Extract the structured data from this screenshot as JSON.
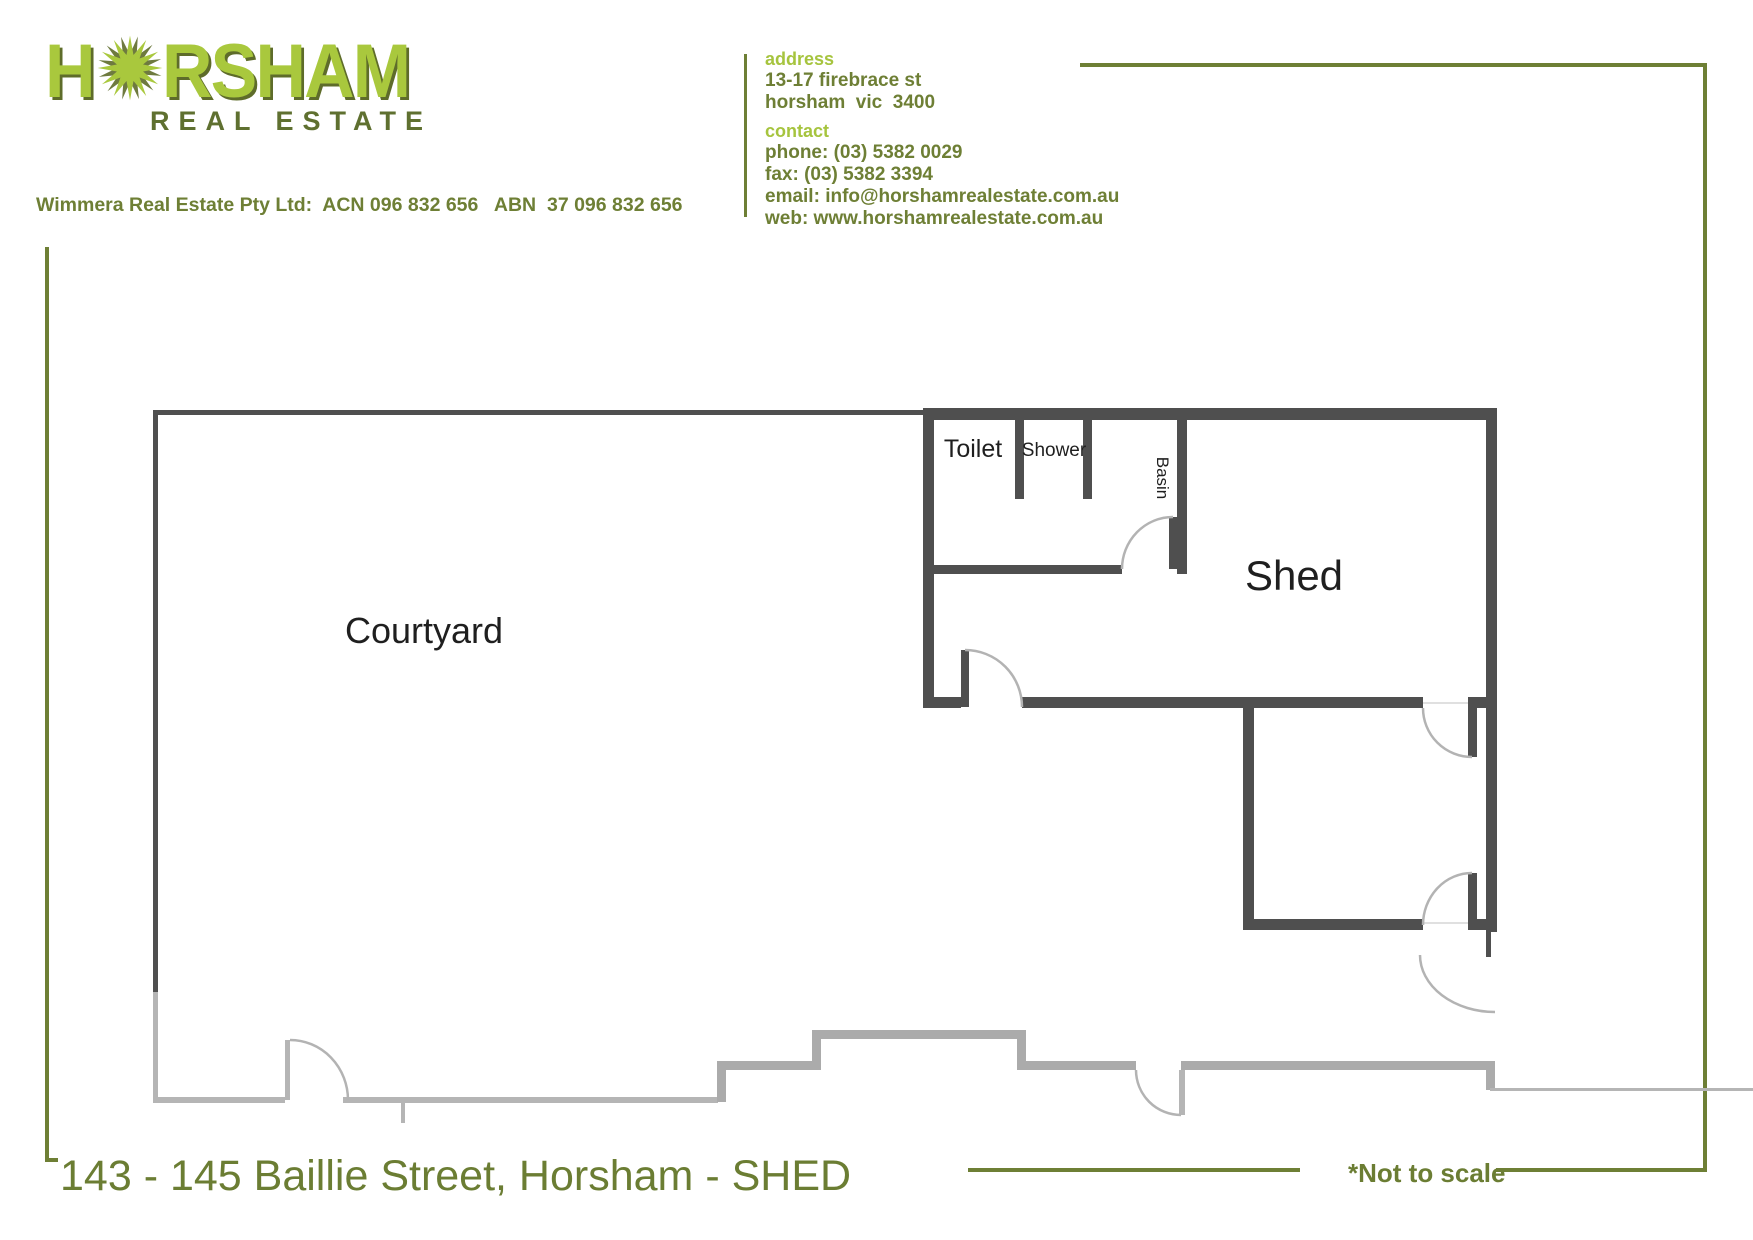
{
  "colors": {
    "olive": "#6e7f35",
    "bright_green": "#a6c43e",
    "logo_green": "#a9c83d",
    "logo_shadow": "#5e6c2a",
    "dark_olive": "#5f7030",
    "title_green": "#6b7d33",
    "wall_dark": "#4f4f4f",
    "wall_light": "#b5b5b5",
    "wall_mid": "#ababab",
    "door_arc": "#b3b3b3",
    "threshold": "#e0e0e0",
    "label_ink": "#1f1f1f"
  },
  "brand": {
    "logo_word_start": "H",
    "logo_word_end": "RSHAM",
    "logo_subtitle": "REAL ESTATE",
    "company_line": "Wimmera Real Estate Pty Ltd:  ACN 096 832 656   ABN  37 096 832 656"
  },
  "contact_card": {
    "address_label": "address",
    "address_line1": "13-17 firebrace st",
    "address_line2": "horsham  vic  3400",
    "contact_label": "contact",
    "phone": "phone: (03) 5382 0029",
    "fax": "fax: (03) 5382 3394",
    "email": "email: info@horshamrealestate.com.au",
    "web": "web: www.horshamrealestate.com.au"
  },
  "floor_plan": {
    "labels": {
      "courtyard": "Courtyard",
      "shed": "Shed",
      "toilet": "Toilet",
      "shower": "Shower",
      "basin": "Basin"
    }
  },
  "footer": {
    "title": "143 - 145 Baillie Street, Horsham - SHED",
    "note": "*Not to scale"
  }
}
